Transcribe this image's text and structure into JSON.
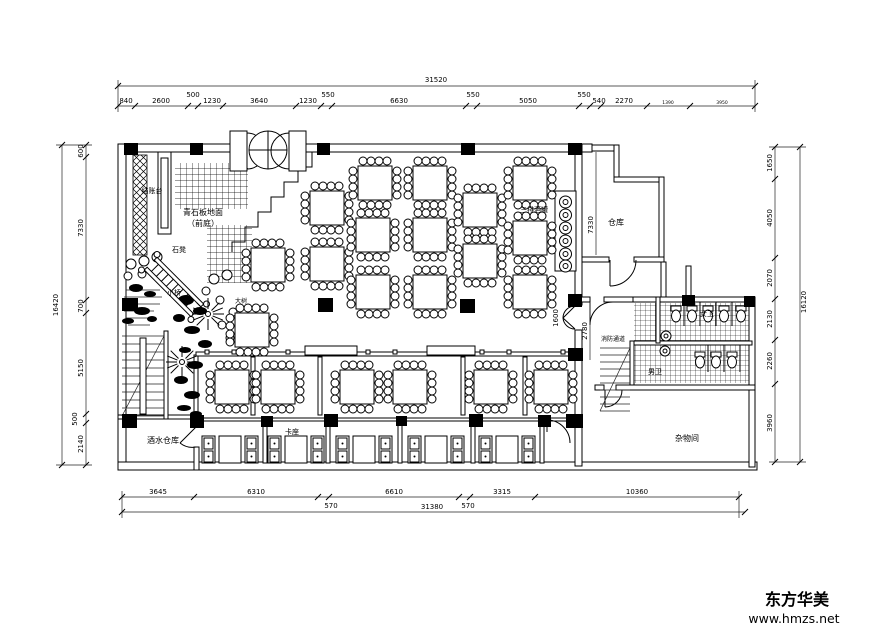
{
  "watermark": {
    "brand": "东方华美",
    "site": "www.hmzs.net"
  },
  "labels": {
    "cashier": "结账台",
    "paving_line1": "青石板地面",
    "paving_line2": "（前庭）",
    "stone_bench": "石凳",
    "small_bridge": "小桥",
    "big_tree": "大树",
    "wine_jars": "三排酒罐",
    "warehouse": "仓库",
    "fire_corridor": "消防通道",
    "womens_wc": "女卫",
    "mens_wc": "男卫",
    "storage_room": "杂物间",
    "beverage_store": "酒水仓库",
    "booth_seating": "卡座"
  },
  "dims": {
    "top": {
      "total": "31520",
      "segments": [
        "840",
        "2600",
        "500",
        "1230",
        "3640",
        "1230",
        "550",
        "6630",
        "550",
        "5050",
        "550",
        "540",
        "2270",
        "1390",
        "3950"
      ]
    },
    "bottom": {
      "total": "31380",
      "segments": [
        "3645",
        "6310",
        "570",
        "6610",
        "570",
        "3315",
        "10360"
      ]
    },
    "left": {
      "total": "16420",
      "segments": [
        "600",
        "7330",
        "700",
        "5150",
        "500",
        "2140"
      ]
    },
    "right": {
      "total": "16120",
      "segments": [
        "1650",
        "4050",
        "2070",
        "2130",
        "2260",
        "3960"
      ]
    },
    "interior": {
      "warehouse_h": "7330",
      "corridor_h": "2780",
      "door_w": "1600"
    }
  },
  "colors": {
    "ink": "#000000",
    "paper": "#ffffff"
  }
}
